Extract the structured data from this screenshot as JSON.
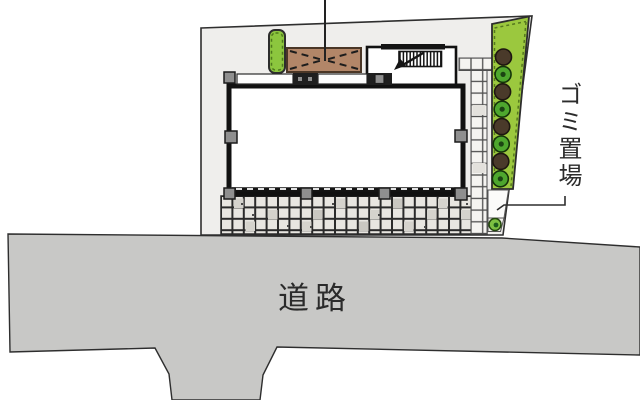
{
  "plan": {
    "title": "site-plan",
    "road_label": "道路",
    "garbage_label": "ゴミ置場"
  },
  "colors": {
    "site": "#efeeec",
    "road": "#c8c8c6",
    "building": "#ffffff",
    "outline": "#2e2e2e",
    "planting": "#9bc83e",
    "planting_small": "#8cc63e",
    "canopy": "#b28668",
    "tree_dark": "#4a3a2a",
    "tree_green": "#4ea72e",
    "shrub_green": "#7cc142"
  },
  "garden": {
    "trees": [
      "dark",
      "green",
      "dark",
      "green",
      "dark",
      "green",
      "dark",
      "green"
    ],
    "shrub_count": 1
  },
  "icons": {
    "stairs": "stairs-icon",
    "tree_dark": "tree-icon",
    "tree_green": "tree-icon",
    "shrub": "shrub-icon",
    "canopy": "canopy-cross-brace-icon"
  }
}
